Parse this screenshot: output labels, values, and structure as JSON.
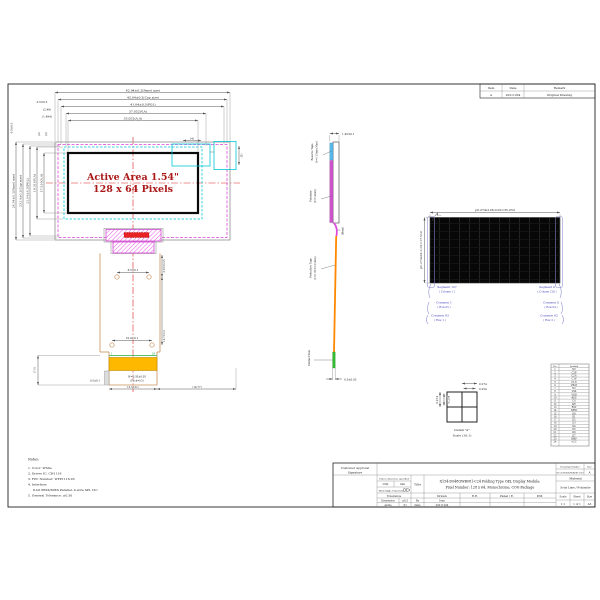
{
  "colors": {
    "magenta_outline": "#dd44dd",
    "cyan_dashed": "#00c8d8",
    "centerline_red": "#dd2222",
    "active_area_text": "#aa1818",
    "fpc_outline": "#c89058",
    "gold_finger": "#ffb800",
    "tape_blue": "#58b8e8",
    "polarizer_purple": "#cc55cc",
    "fpc_orange": "#ff8800",
    "contact_green": "#33bb33",
    "annotation_blue": "#3a3ab8"
  },
  "revision_table": {
    "headers": [
      "Item",
      "Date",
      "Remark"
    ],
    "rows": [
      [
        "A",
        "20211204",
        "Original Drawing"
      ]
    ]
  },
  "front_view": {
    "active_area_line1": "Active Area 1.54\"",
    "active_area_line2": "128 x 64 Pixels",
    "dims_top": [
      "42.94±0.2(Panel size)",
      "42.04±0.2(Cap size)",
      "41.04±0.3(POL)",
      "37.052(V.A)",
      "35.052(A.A)"
    ],
    "dims_left": [
      "24.04±0.2(Panel size)",
      "23.14±0.2(Cap size)",
      "21.04±0.3(POL)",
      "19.516(V.A)",
      "17.516(A.A)"
    ],
    "offsets": {
      "o1": "0.5±0.3",
      "o2": "(2.49)",
      "o3": "(1.494)",
      "o4": "0.5±0.3",
      "o5": "(2)",
      "o6": "(2)",
      "d1": "(4)",
      "d2": "(5)"
    }
  },
  "fpc": {
    "holes_dim_top": "8.5±0.1",
    "holes_dim_bottom": "10.4±0.1",
    "len1": "3.05±0.05",
    "len2": "16.7±0.3",
    "left_height": "(7.0)",
    "offset": "0.5±0.1",
    "finger_w": "W=0.35±0.05",
    "pitch": "(Pitch=0.5)",
    "width": "12.5±0.1",
    "right_ref": "(14.77)",
    "pin_first": "1",
    "pin_last": "24"
  },
  "side_view": {
    "thickness": "1.45±0.1",
    "reserve_tape_1": "Reserve Tape",
    "reserve_tape_2": "(t=0.15mm Max)",
    "polarizer_1": "Polarizer",
    "polarizer_2": "(t=0.2mm)",
    "bend": "(Bend)",
    "protective_tape_1": "Protective Tape",
    "protective_tape_2": "(t=0.05±0.01mm)",
    "contact_side": "Contact Side",
    "contact_thickness": "0.3±0.05"
  },
  "pixel_diagram": {
    "dim_h": "p0.274x128-0.02=35.052",
    "dim_v": "p0.274x64-0.02=17.516",
    "marker": "A",
    "left_labels": [
      {
        "main": "Segment 127",
        "sub": "( Column 1 )"
      },
      {
        "main": "Common 1",
        "sub": "( Row 63 )"
      },
      {
        "main": "Common 63",
        "sub": "( Row 1 )"
      }
    ],
    "right_labels": [
      {
        "main": "Segment 0",
        "sub": "( Column 128 )"
      },
      {
        "main": "Common 0",
        "sub": "( Row 64 )"
      },
      {
        "main": "Common 62",
        "sub": "( Row 2 )"
      }
    ]
  },
  "detail_a": {
    "dim1": "0.274",
    "dim2": "0.254",
    "dim3": "0.274",
    "dim4": "0.254",
    "caption1": "Detail \"A\"",
    "caption2": "Scale (10:1)"
  },
  "notes": {
    "title": "Notes:",
    "items": [
      "1. Color: White",
      "2. Driver IC: CH1116",
      "3. FPC Number: WFP1116-05",
      "4. Interface:",
      "8-bit 68XX/80XX Parallel, 4-wire SPI, I2C",
      "5. General Tolerance: ±0.30"
    ]
  },
  "title_block": {
    "customer_approval": "Customer Approval",
    "signature": "Signature",
    "unless": "Unless otherwise specified",
    "unit_label": "Unit",
    "unit_value": "mm",
    "projection": "Third Angle Projection",
    "title_label": "Title",
    "title_line1": "X154-D048QWB081-C24 Folding Type OEL Display Module;",
    "title_line2": "Pixel Number: 128 x 64, Monochrome, COG Package",
    "tolerance": "Tolerance",
    "dimension_label": "Dimension",
    "dimension_value": "±0.3",
    "angle_label": "Angle",
    "angle_value": "±1",
    "by_label": "By",
    "by_value": "Ivan",
    "date_label": "Date",
    "date_value": "20211204",
    "col_headers": [
      "Drawn",
      "E.E.",
      "Panel / E.",
      "P.M."
    ],
    "drawing_number_label": "Drawing Number",
    "rev_label": "Rev.",
    "drawing_number": "X154-D048QWB081-C24",
    "rev": "A",
    "material_label": "Material",
    "material": "Soda Lime / Polyimide",
    "scale_label": "Scale",
    "sheet_label": "Sheet",
    "size_label": "Size",
    "scale": "1:1",
    "sheet": "1 of 1",
    "size": "A3"
  },
  "pin_table": {
    "headers": [
      "No.",
      "Symbol"
    ],
    "rows": [
      [
        "1",
        "NC"
      ],
      [
        "2",
        "C2P"
      ],
      [
        "3",
        "C2N"
      ],
      [
        "4",
        "C1P"
      ],
      [
        "5",
        "C1N"
      ],
      [
        "6",
        "VBAT"
      ],
      [
        "7",
        "NC"
      ],
      [
        "8",
        "VSS"
      ],
      [
        "9",
        "VDD"
      ],
      [
        "10",
        "RES"
      ],
      [
        "11",
        "CS"
      ],
      [
        "12",
        "D/C"
      ],
      [
        "13",
        "R/W"
      ],
      [
        "14",
        "E/RD"
      ],
      [
        "15",
        "D0"
      ],
      [
        "16",
        "D1"
      ],
      [
        "17",
        "D2"
      ],
      [
        "18",
        "D3"
      ],
      [
        "19",
        "D4"
      ],
      [
        "20",
        "D5"
      ],
      [
        "21",
        "D6"
      ],
      [
        "22",
        "D7"
      ],
      [
        "23",
        "IREF"
      ],
      [
        "24",
        "VCC"
      ]
    ]
  }
}
